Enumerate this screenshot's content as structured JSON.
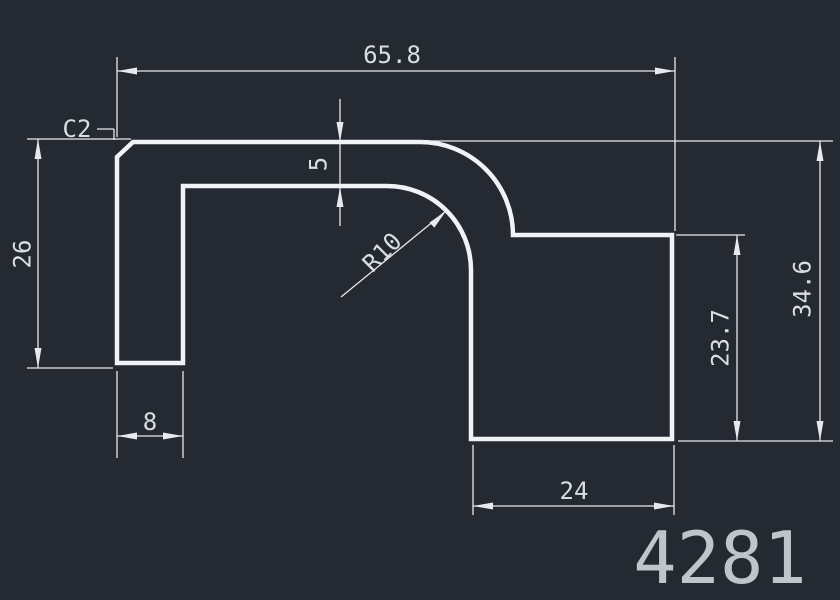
{
  "canvas": {
    "width": 840,
    "height": 600,
    "background": "#242932"
  },
  "colors": {
    "background": "#242932",
    "profile_line": "#f0f3f6",
    "dimension_line": "#e6eaee",
    "dimension_text": "#d9dee3",
    "part_number_text": "#c9ced5"
  },
  "drawing": {
    "part_number": "4281",
    "labels": {
      "overall_width": "65.8",
      "chamfer": "C2",
      "top_wall_thickness": "5",
      "left_height": "26",
      "inner_radius": "R10",
      "overall_height": "34.6",
      "step_height": "23.7",
      "leg_width": "8",
      "bottom_width": "24"
    }
  }
}
